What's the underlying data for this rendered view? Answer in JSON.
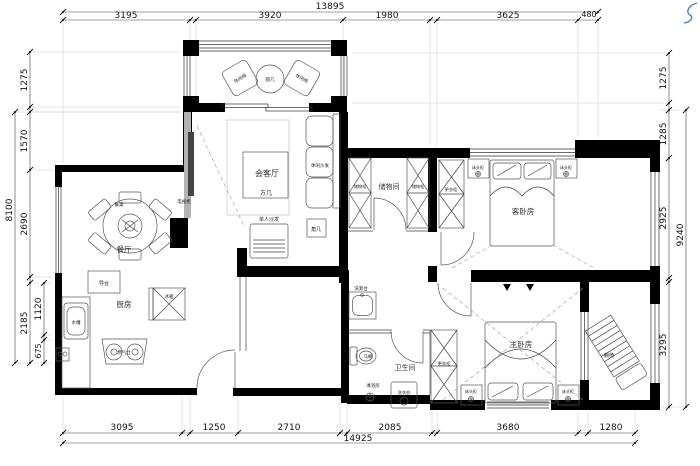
{
  "colors": {
    "wall": "#000000",
    "partition": "#b3b3b3",
    "line": "#555555",
    "dim_text": "#111111",
    "scribble": "#4a7fc1"
  },
  "dims": {
    "top": {
      "total": "13895",
      "segments": [
        "3195",
        "3920",
        "1980",
        "3625",
        "480"
      ]
    },
    "bottom": {
      "total": "14925",
      "segments": [
        "3095",
        "1250",
        "2710",
        "2085",
        "3680",
        "1280"
      ]
    },
    "left": {
      "total": "8100",
      "segments": [
        "1275",
        "1570",
        "2690",
        "2185"
      ],
      "inner_segments": [
        "1120",
        "675"
      ]
    },
    "right": {
      "total": "9240",
      "segments": [
        "1275",
        "1285",
        "2925",
        "3295"
      ]
    }
  },
  "rooms": {
    "living": {
      "label": "会客厅"
    },
    "dining": {
      "label": "餐厅"
    },
    "kitchen": {
      "label": "厨房"
    },
    "storage": {
      "label": "储物间"
    },
    "guest_bedroom": {
      "label": "客卧房"
    },
    "master_bedroom": {
      "label": "主卧房"
    },
    "bathroom": {
      "label": "卫生间"
    }
  },
  "furniture": {
    "leisure_chair": "休闲椅",
    "round_side_table": "圆几",
    "square_table": "方几",
    "leisure_sofa": "休闲沙发",
    "single_sofa": "单人沙发",
    "corner_table": "角几",
    "tv_cabinet": "电视柜",
    "dining_table": "餐桌",
    "island_counter": "导台",
    "fridge": "冰箱",
    "sink": "水槽",
    "gas_stove": "燃气灶",
    "storage_cabinet": "储物柜",
    "wardrobe": "更衣柜",
    "nightstand": "床头柜",
    "washbasin": "洗漱台",
    "toilet": "马桶",
    "shower_room": "淋浴房",
    "washing_machine": "洗衣机",
    "lounge_chair": "躺椅"
  }
}
